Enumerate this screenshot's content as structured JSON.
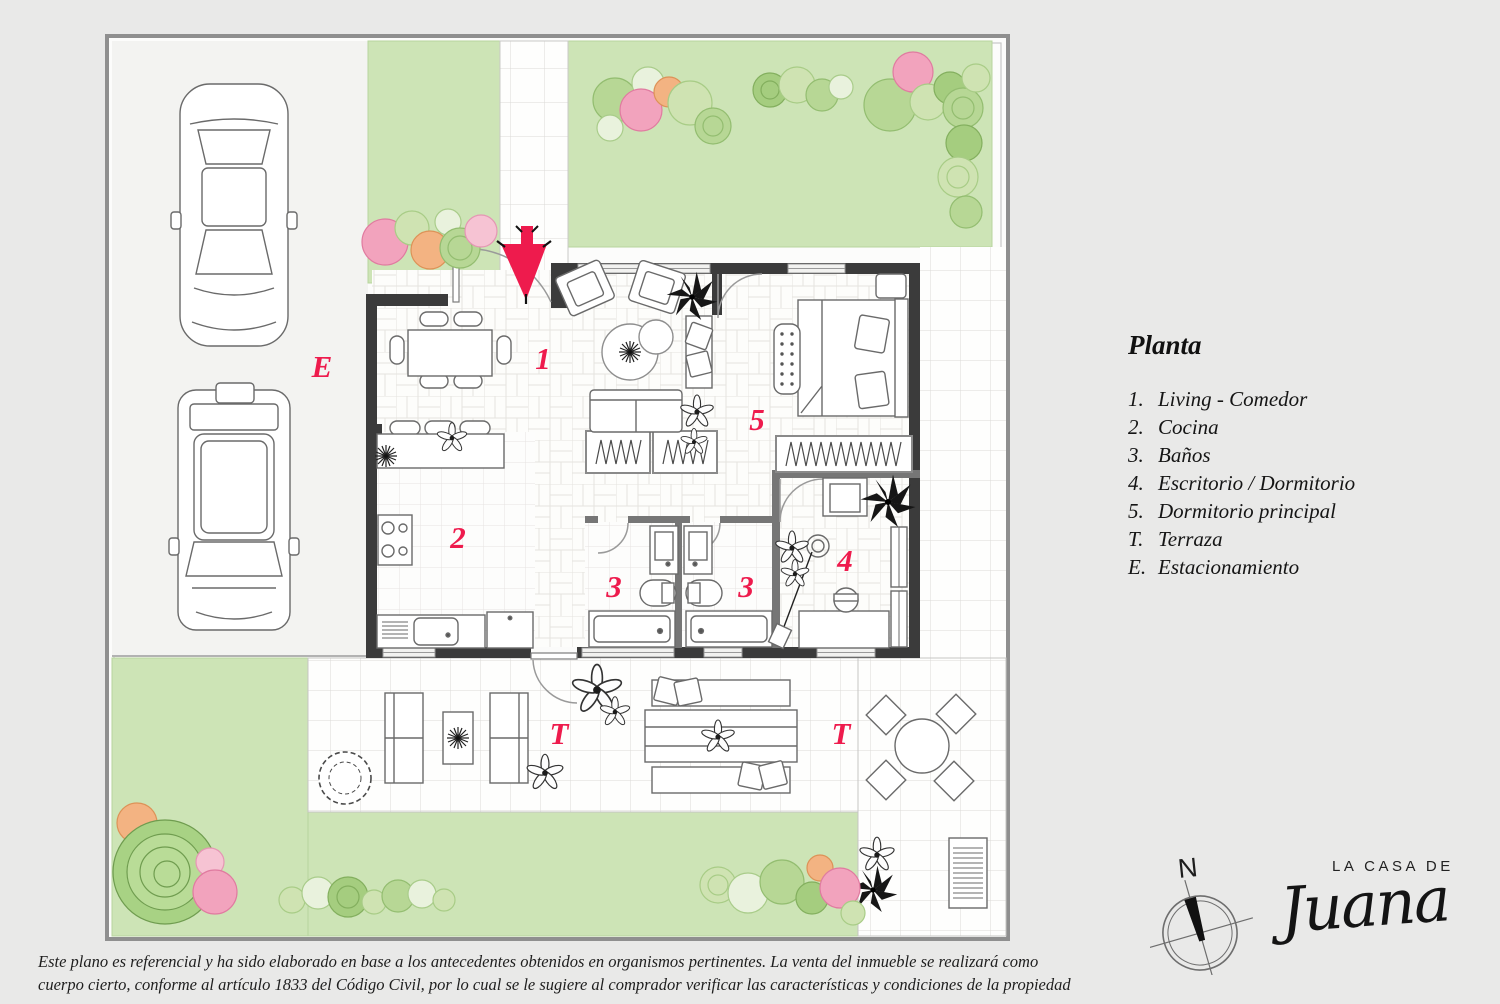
{
  "plan": {
    "accent_color": "#ee1b4d",
    "wall_color": "#3b3b3b",
    "garden_color": "#cde4b6",
    "room_labels": [
      {
        "id": "living-comedor",
        "text": "1"
      },
      {
        "id": "cocina",
        "text": "2"
      },
      {
        "id": "bano-izquierdo",
        "text": "3"
      },
      {
        "id": "bano-derecho",
        "text": "3"
      },
      {
        "id": "escritorio-dormitorio",
        "text": "4"
      },
      {
        "id": "dormitorio-principal",
        "text": "5"
      },
      {
        "id": "terraza-izquierda",
        "text": "T"
      },
      {
        "id": "terraza-derecha",
        "text": "T"
      },
      {
        "id": "estacionamiento",
        "text": "E"
      }
    ]
  },
  "legend": {
    "title": "Planta",
    "items": [
      {
        "key": "1.",
        "label": "Living - Comedor"
      },
      {
        "key": "2.",
        "label": "Cocina"
      },
      {
        "key": "3.",
        "label": "Baños"
      },
      {
        "key": "4.",
        "label": "Escritorio / Dormitorio"
      },
      {
        "key": "5.",
        "label": "Dormitorio principal"
      },
      {
        "key": "T.",
        "label": "Terraza"
      },
      {
        "key": "E.",
        "label": "Estacionamiento"
      }
    ]
  },
  "compass": {
    "north_label": "N"
  },
  "logo": {
    "top": "LA CASA DE",
    "script": "Juana"
  },
  "disclaimer": {
    "line1": "Este plano es referencial y ha sido elaborado en base a los antecedentes obtenidos en organismos pertinentes.  La venta del inmueble se realizará como",
    "line2": "cuerpo cierto, conforme al artículo 1833 del Código Civil, por lo cual se le sugiere al comprador verificar las características y condiciones de la propiedad"
  }
}
